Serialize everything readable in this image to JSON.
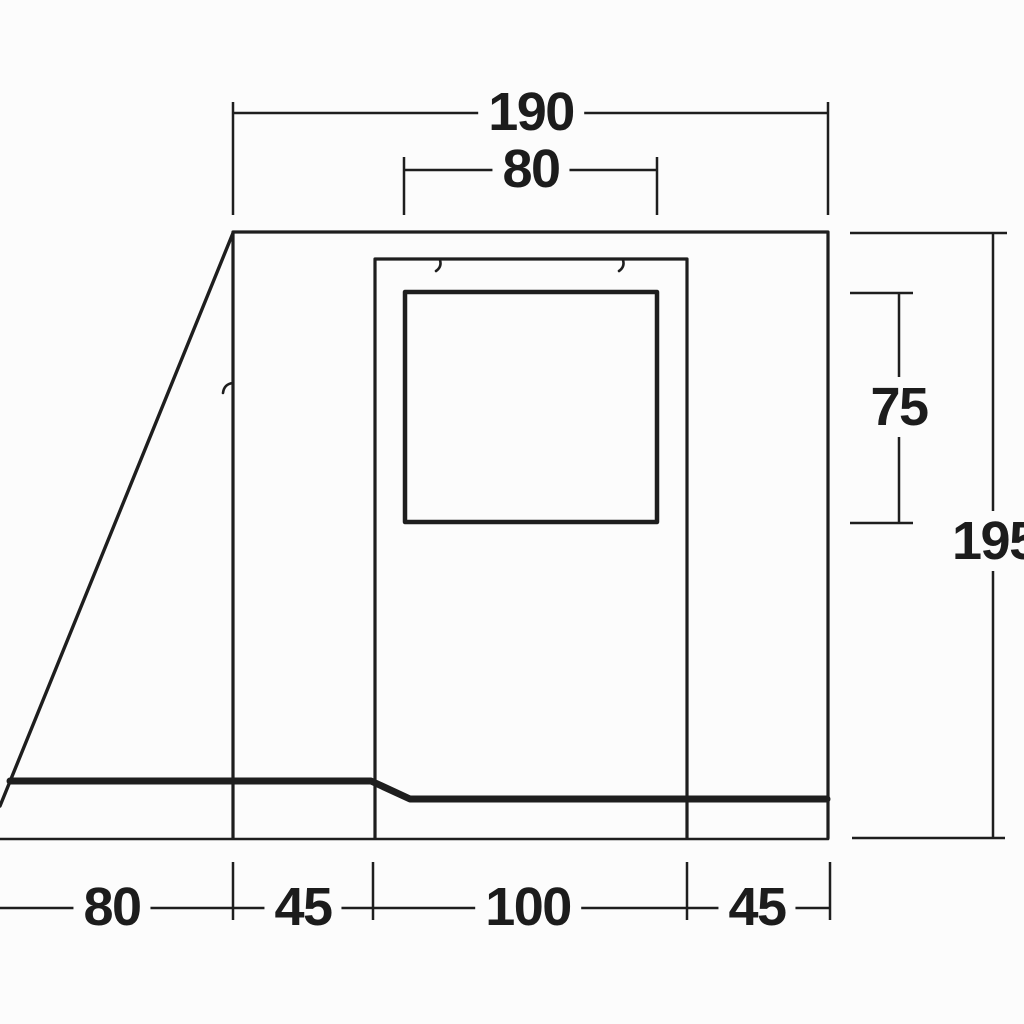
{
  "diagram": {
    "kind": "technical-dimension-drawing",
    "subject": "awning-side-profile",
    "dimensions": {
      "top": {
        "overall_width": "190",
        "window_width": "80"
      },
      "right": {
        "window_height": "75",
        "overall_height": "195"
      },
      "bottom": [
        "80",
        "45",
        "100",
        "45"
      ]
    },
    "icons": {
      "zipper_pulls": [
        "zipper-pull-icon",
        "zipper-pull-icon",
        "zipper-pull-icon"
      ]
    },
    "colors": {
      "line": "#1e1e1e",
      "text": "#1c1c1c",
      "background": "#fcfcfc"
    }
  }
}
